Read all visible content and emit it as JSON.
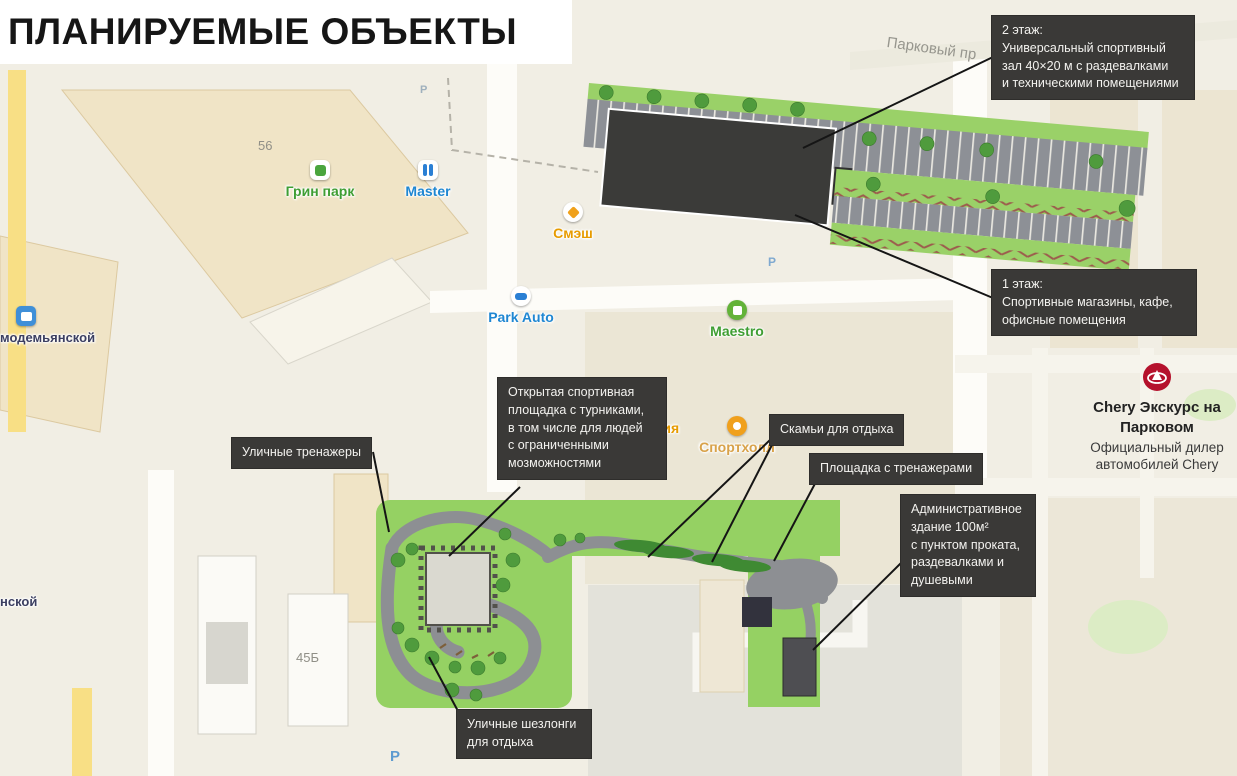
{
  "title": "ПЛАНИРУЕМЫЕ ОБЪЕКТЫ",
  "colors": {
    "annotation_bg": "#3a3937",
    "annotation_text": "#f3f2ef",
    "map_bg": "#f1eee4",
    "park_green": "#95d163",
    "planned_building_dark": "#3b3b39",
    "poi_blue": "#1f87d2",
    "poi_green": "#3f9e33",
    "poi_orange": "#e79b00",
    "chery_red": "#b5122d"
  },
  "annotations": {
    "floor2": "2 этаж:\nУниверсальный спортивный\nзал 40×20 м с раздевалками\nи техническими помещениями",
    "floor1": "1 этаж:\nСпортивные магазины, кафе,\nофисные помещения",
    "open_playground": "Открытая спортивная\nплощадка с турниками,\nв том числе для людей\nс ограниченными\nмозможностями",
    "benches": "Скамьи для отдыха",
    "trainers_ground": "Площадка с тренажерами",
    "street_trainers": "Уличные тренажеры",
    "admin_building": "Административное\nздание 100м²\nс пунктом проката,\nраздевалками и\nдушевыми",
    "loungers": "Уличные шезлонги\nдля отдыха"
  },
  "pois": {
    "grin_park": "Грин парк",
    "master": "Master",
    "smesh": "Смэш",
    "park_auto": "Park Auto",
    "maestro": "Maestro",
    "sporthall": "Спортхолл",
    "akademia_fragment": "мия",
    "chery_title": "Chery Экскурс на\nПарковом",
    "chery_subtitle": "Официальный дилер\nавтомобилей Chery"
  },
  "streets": {
    "parkovy": "Парковый пр",
    "kosmodemyanskoy_fragment": "модемьянской",
    "left_fragment": "нской"
  },
  "building_numbers": {
    "n56": "56",
    "n45b": "45Б"
  },
  "map_icons": {
    "parking_letter": "P"
  }
}
